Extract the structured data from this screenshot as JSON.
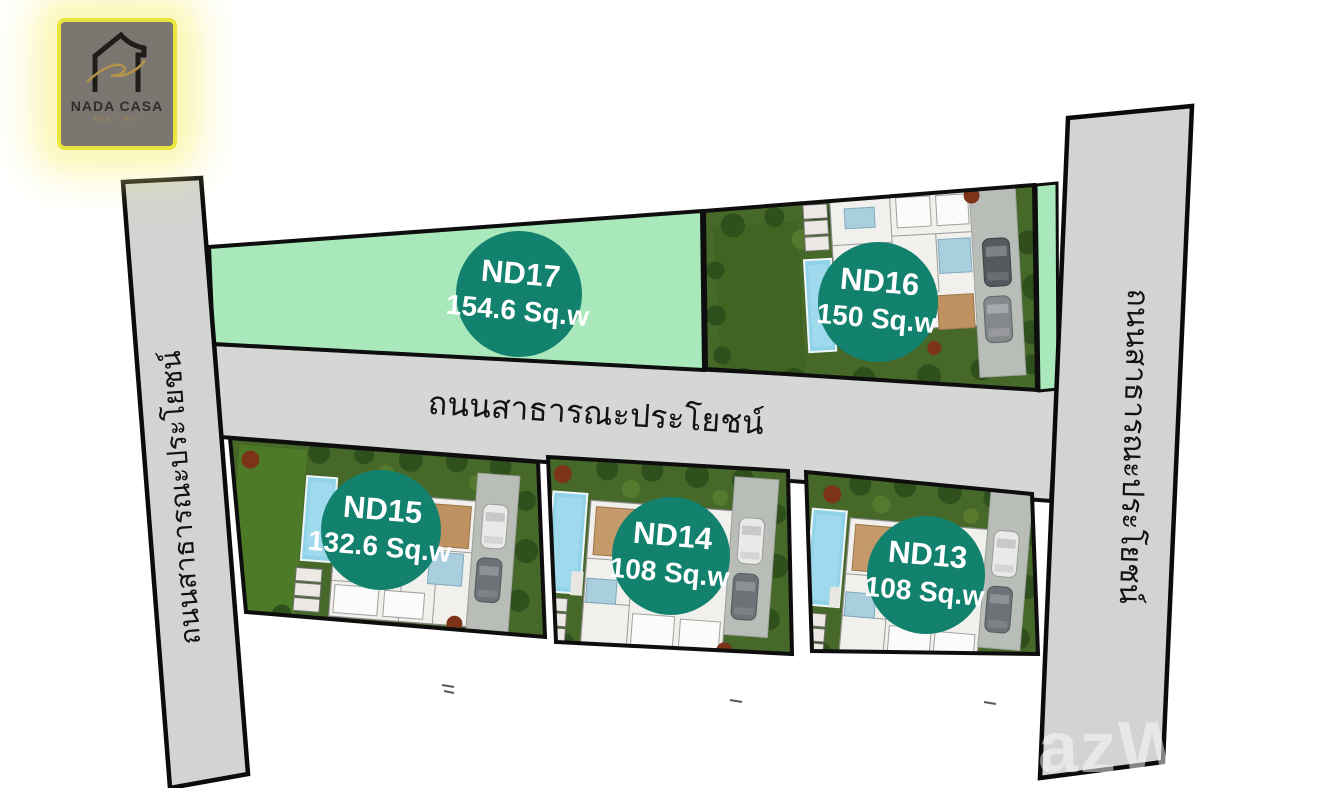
{
  "logo": {
    "title": "NADA CASA",
    "subtitle": "Hua - Hin",
    "icon": "house-with-gold-swoosh"
  },
  "roads": {
    "left": {
      "label": "ถนนสาธารณะประโยชน์"
    },
    "middle": {
      "label": "ถนนสาธารณะประโยชน์"
    },
    "right": {
      "label": "ถนนสาธารณะประโยชน์"
    }
  },
  "plots": [
    {
      "id": "ND17",
      "area": "154.6 Sq.w",
      "type": "vacant"
    },
    {
      "id": "ND16",
      "area": "150 Sq.w",
      "type": "house-with-pool"
    },
    {
      "id": "ND15",
      "area": "132.6 Sq.w",
      "type": "house-with-pool"
    },
    {
      "id": "ND14",
      "area": "108 Sq.w",
      "type": "house-with-pool"
    },
    {
      "id": "ND13",
      "area": "108 Sq.w",
      "type": "house-with-pool"
    }
  ],
  "watermark": {
    "text": "FazW"
  },
  "colors": {
    "marker_teal": "#12816E",
    "vacant_plot_green": "#A8E8BB",
    "road_gray": "#D1D4D0",
    "garden_green": "#466829",
    "pool_blue": "#90D2E8",
    "logo_border_yellow": "#E9E63E"
  }
}
